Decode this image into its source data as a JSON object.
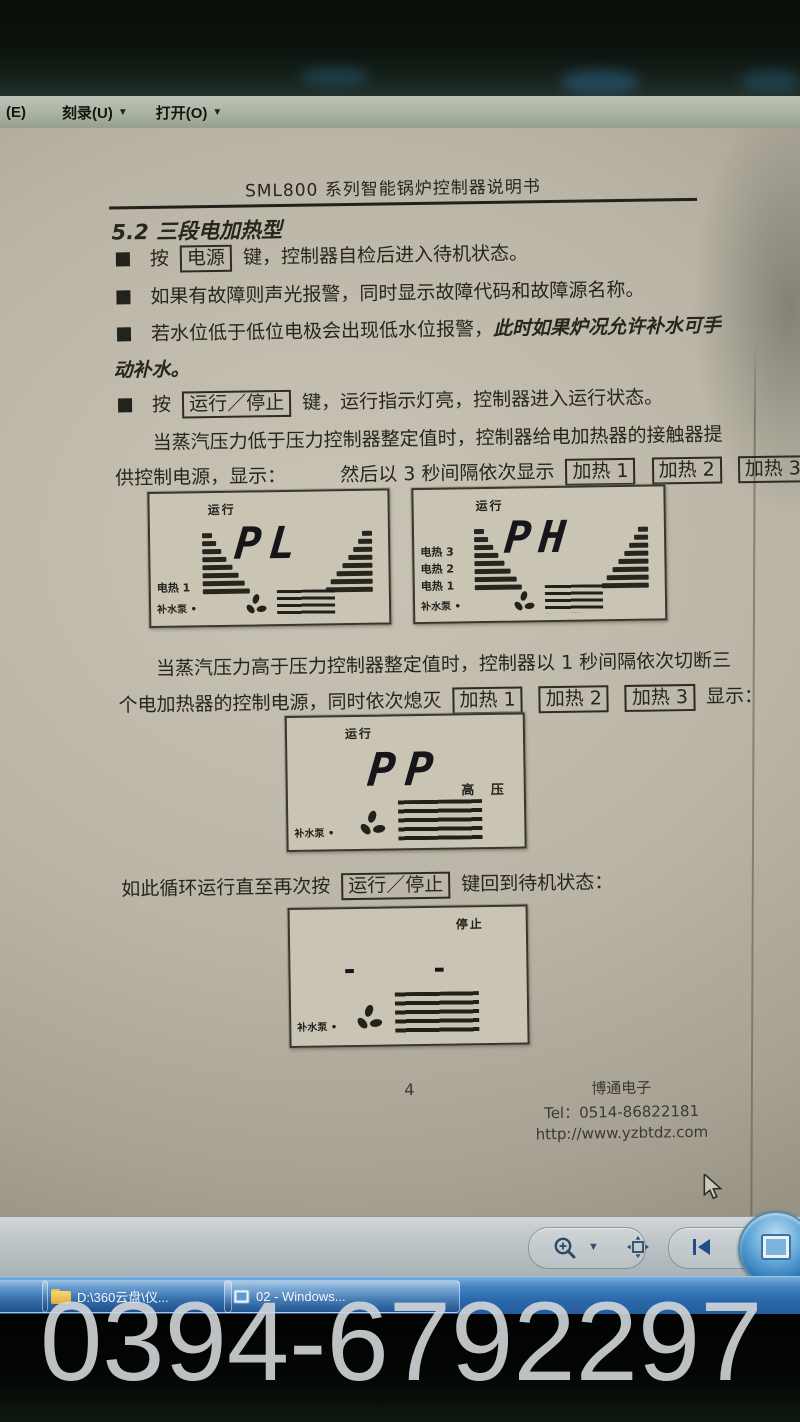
{
  "menu": {
    "partial": "(E)",
    "burn_label": "刻录(U)",
    "open_label": "打开(O)"
  },
  "document": {
    "title": "SML800 系列智能锅炉控制器说明书",
    "section_heading": "5.2 三段电加热型",
    "b1_pre": "按",
    "b1_key": "电源",
    "b1_post": "键，控制器自检后进入待机状态。",
    "b2": "如果有故障则声光报警，同时显示故障代码和故障源名称。",
    "b3_normal": "若水位低于低位电极会出现低水位报警，",
    "b3_italic1": "此时如果炉况允许补水可手",
    "b3_italic2": "动补水。",
    "b4_pre": "按",
    "b4_key": "运行／停止",
    "b4_post": "键，运行指示灯亮，控制器进入运行状态。",
    "p1_line1": "当蒸汽压力低于压力控制器整定值时，控制器给电加热器的接触器提",
    "p1_line2a": "供控制电源，显示：",
    "p1_line2b": "然后以 3 秒间隔依次显示",
    "heat_keys": [
      "加热 1",
      "加热 2",
      "加热 3"
    ],
    "p2_line1": "当蒸汽压力高于压力控制器整定值时，控制器以 1 秒间隔依次切断三",
    "p2_line2a": "个电加热器的控制电源，同时依次熄灭",
    "p2_line2b": "显示：",
    "loop_pre": "如此循环运行直至再次按",
    "loop_key": "运行／停止",
    "loop_post": "键回到待机状态：",
    "page_number": "4",
    "footer_company": "博通电子",
    "footer_tel": "Tel：0514-86822181",
    "footer_url": "http://www.yzbtdz.com"
  },
  "lcd_pl": {
    "status": "运行",
    "value": "PL",
    "labels": [
      "电热 1",
      "补水泵 •"
    ]
  },
  "lcd_ph": {
    "status": "运行",
    "value": "PH",
    "labels": [
      "电热 3",
      "电热 2",
      "电热 1",
      "补水泵 •"
    ]
  },
  "lcd_pp": {
    "status": "运行",
    "value": "PP",
    "side_label": "高  压",
    "labels": [
      "补水泵 •"
    ]
  },
  "lcd_stop": {
    "status": "停止",
    "value": "- -",
    "labels": [
      "补水泵 •"
    ]
  },
  "taskbar": {
    "item1_label": "D:\\360云盘\\仪...",
    "item2_label": "02 - Windows..."
  },
  "watermark": "0394-6792297",
  "colors": {
    "taskbar_blue": "#2b68aa",
    "paper": "#bab5a6",
    "ink": "#26261f",
    "watermark_gray": "#d1d6d9"
  }
}
